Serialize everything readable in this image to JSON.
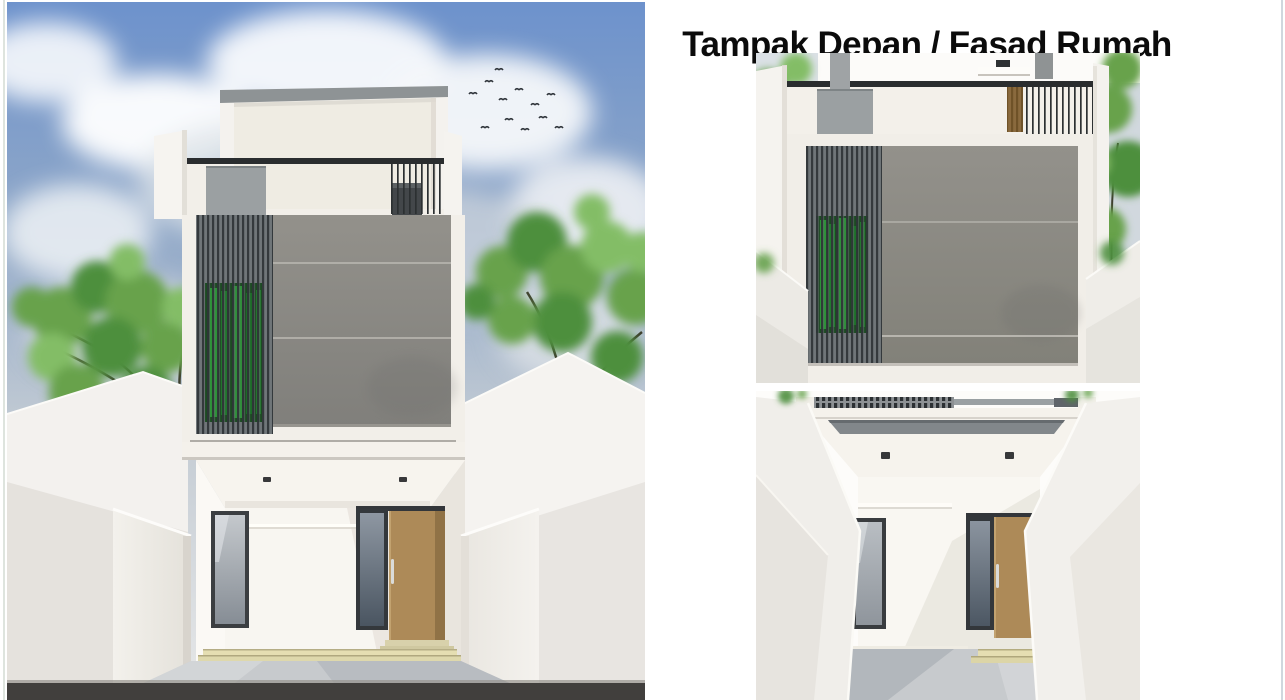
{
  "title": "Tampak Depan / Fasad Rumah",
  "colors": {
    "page_bg": "#ffffff",
    "title_text": "#0b0b0b",
    "sky_blue": "#6d92cc",
    "foliage_green": "#67a24c",
    "foliage_dark": "#4e8f3d",
    "foliage_light": "#83bd66",
    "wall_white": "#f4f2ee",
    "cream_panel": "#efece3",
    "facade_gray": "#8b8a86",
    "terrace_gray": "#9ba0a2",
    "louver_bg": "#6e7477",
    "louver_dark": "#2f3437",
    "railing_dark": "#2a2d2f",
    "window_green": "#2f9e3b",
    "green_glass_dark": "#1c4a22",
    "door_wood": "#ad8a58",
    "door_wood_shade": "#8d6f45",
    "wood_louver": "#8a6a3e",
    "glass_light": "#9aa0a6",
    "glass_dark": "#4d5863",
    "step_yellow": "#e5deb2",
    "driveway_gray": "#c7cacd",
    "road_dark": "#413f3d"
  }
}
